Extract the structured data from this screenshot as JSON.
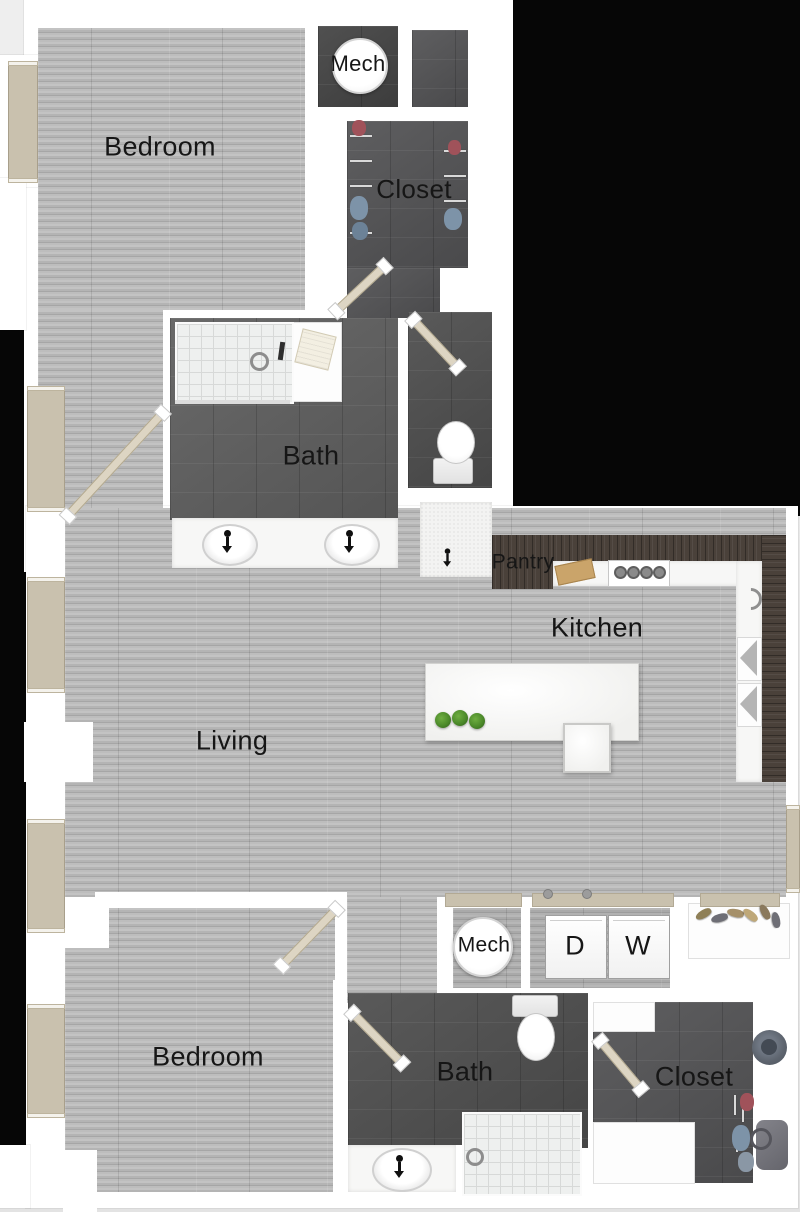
{
  "rooms": {
    "bedroom_top": {
      "label": "Bedroom"
    },
    "mech_top": {
      "label": "Mech"
    },
    "closet_top": {
      "label": "Closet"
    },
    "bath_top": {
      "label": "Bath"
    },
    "pantry": {
      "label": "Pantry"
    },
    "kitchen": {
      "label": "Kitchen"
    },
    "living": {
      "label": "Living"
    },
    "mech_bottom": {
      "label": "Mech"
    },
    "dryer": {
      "label": "D"
    },
    "washer": {
      "label": "W"
    },
    "bedroom_bottom": {
      "label": "Bedroom"
    },
    "bath_bottom": {
      "label": "Bath"
    },
    "closet_bottom": {
      "label": "Closet"
    }
  },
  "colors": {
    "background": "#e9e9e9",
    "outside_black": "#060606",
    "wall_white": "#ffffff",
    "wood_floor": "#b5b5b5",
    "dark_tile": "#5e5e5e",
    "darker_tile": "#434343",
    "cabinet_wood": "#4a413a",
    "window_beige": "#c9c1ae",
    "door_beige": "#ddd5c3",
    "plant_green": "#4c8a2a",
    "shower_tile": "#eef0ef"
  }
}
